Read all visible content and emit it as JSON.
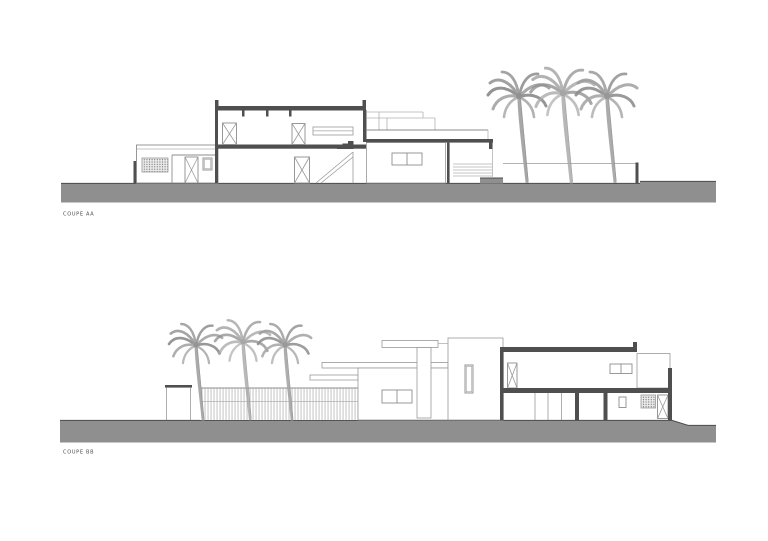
{
  "sheet": {
    "background": "#ffffff"
  },
  "drawings": [
    {
      "label": "COUPE AA",
      "palm_trees": 3
    },
    {
      "label": "COUPE BB",
      "palm_trees": 3
    }
  ],
  "colors": {
    "ground": "#8f8f8f",
    "ground_edge": "#4c4c4c",
    "cut_elements": "#4f4f4f",
    "thin_lines": "#8d8d8d",
    "palm_gray": "#9b9b9b",
    "label_text": "#4a4a4a"
  }
}
